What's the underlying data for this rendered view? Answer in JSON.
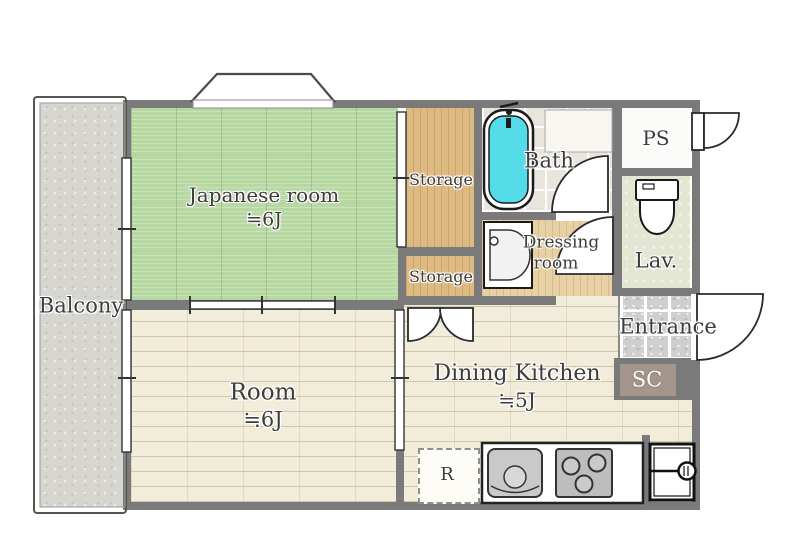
{
  "plan": {
    "title": "1DK apartment floor plan",
    "rooms": {
      "balcony": {
        "label": "Balcony"
      },
      "japanese_room": {
        "label": "Japanese room",
        "size": "≒6J"
      },
      "storage_upper": {
        "label": "Storage"
      },
      "storage_lower": {
        "label": "Storage"
      },
      "bath": {
        "label": "Bath"
      },
      "ps": {
        "label": "PS"
      },
      "lav": {
        "label": "Lav."
      },
      "dressing_room": {
        "label_line1": "Dressing",
        "label_line2": "room"
      },
      "entrance": {
        "label": "Entrance"
      },
      "shoe_closet": {
        "label": "SC"
      },
      "dining_kitchen": {
        "label": "Dining Kitchen",
        "size": "≒5J"
      },
      "room": {
        "label": "Room",
        "size": "≒6J"
      },
      "refrigerator": {
        "label": "R"
      }
    },
    "colors": {
      "wall": "#7a7a7a",
      "tatami_green": "#b8d8a2",
      "wood_floor": "#f2ecda",
      "closet_wood": "#deba83",
      "balcony_gray": "#d6d5d0",
      "bath_water_cyan": "#54dbe8",
      "entrance_tile": "#cfcfcf",
      "sc_brown": "#a4968c",
      "lav_green": "#e2e6d3",
      "label_text": "#3c3c3c"
    }
  }
}
